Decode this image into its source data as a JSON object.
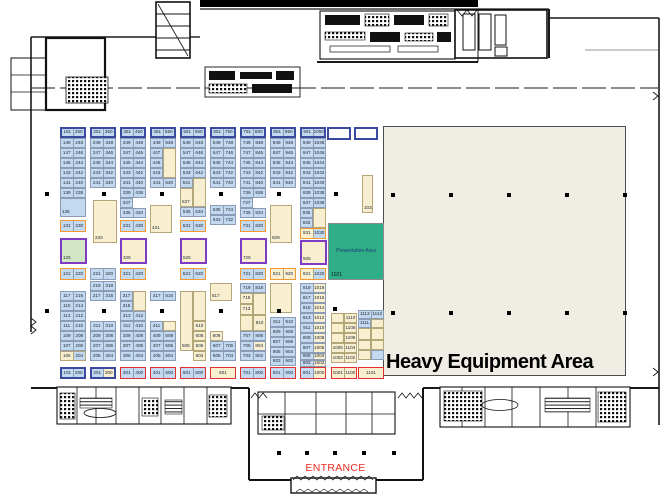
{
  "colors": {
    "booth_blue": "#c3d9ef",
    "booth_tan": "#f7efcf",
    "booth_green": "#d2e8c4",
    "booth_white": "#ffffff",
    "border_navy": "#3a4a9f",
    "border_orange": "#f09a2f",
    "border_purple": "#7e3bc4",
    "border_red": "#e23030",
    "presentation_green": "#2fae87",
    "heavy_fill": "#f0ede5",
    "entrance_red": "#ea2b20"
  },
  "areas": {
    "heavy_equipment": {
      "label": "Heavy Equipment Area"
    },
    "presentation": {
      "label": "Presentation Area",
      "booth": "1021"
    },
    "entrance": {
      "label": "ENTRANCE"
    }
  },
  "booths": [
    [
      60,
      127,
      26,
      11,
      "N",
      "b|b",
      "151|250"
    ],
    [
      60,
      138,
      26,
      10,
      "n",
      "b|b",
      "149|248"
    ],
    [
      60,
      148,
      26,
      10,
      "n",
      "b|b",
      "147|246"
    ],
    [
      60,
      158,
      26,
      10,
      "n",
      "b|b",
      "145|244"
    ],
    [
      60,
      168,
      26,
      10,
      "n",
      "b|b",
      "143|242"
    ],
    [
      60,
      178,
      26,
      10,
      "n",
      "b|b",
      "141|240"
    ],
    [
      60,
      188,
      26,
      10,
      "n",
      "b|b",
      "139|238"
    ],
    [
      60,
      198,
      26,
      19,
      "n",
      "b",
      "135"
    ],
    [
      60,
      220,
      26,
      12,
      "O",
      "b|b",
      "131|230"
    ],
    [
      60,
      238,
      27,
      26,
      "P",
      "g",
      "125"
    ],
    [
      60,
      268,
      26,
      12,
      "O",
      "b|b",
      "121|220"
    ],
    [
      60,
      291,
      26,
      10,
      "n",
      "b|b",
      "117|216"
    ],
    [
      60,
      301,
      26,
      10,
      "n",
      "b|b",
      "115|214"
    ],
    [
      60,
      311,
      26,
      10,
      "n",
      "b|b",
      "113|212"
    ],
    [
      60,
      321,
      26,
      10,
      "n",
      "b|b",
      "111|210"
    ],
    [
      60,
      331,
      26,
      10,
      "n",
      "b|b",
      "109|208"
    ],
    [
      60,
      341,
      26,
      10,
      "n",
      "b|b",
      "107|206"
    ],
    [
      60,
      351,
      26,
      10,
      "n",
      "t|b",
      "105|204"
    ],
    [
      60,
      367,
      26,
      12,
      "N",
      "b|b",
      "101|200"
    ],
    [
      90,
      127,
      26,
      11,
      "N",
      "b|b",
      "251|350"
    ],
    [
      90,
      138,
      26,
      10,
      "n",
      "b|b",
      "249|348"
    ],
    [
      90,
      148,
      26,
      10,
      "n",
      "b|b",
      "247|346"
    ],
    [
      90,
      158,
      26,
      10,
      "n",
      "b|b",
      "245|344"
    ],
    [
      90,
      168,
      26,
      10,
      "n",
      "b|b",
      "243|342"
    ],
    [
      90,
      178,
      26,
      10,
      "n",
      "b|b",
      "241|340"
    ],
    [
      93,
      200,
      24,
      43,
      "n",
      "t",
      "233"
    ],
    [
      90,
      268,
      26,
      12,
      "n",
      "b|b",
      "221|320"
    ],
    [
      90,
      281,
      26,
      10,
      "n",
      "b|b",
      "219|318"
    ],
    [
      90,
      291,
      26,
      10,
      "n",
      "b|b",
      "217|316"
    ],
    [
      90,
      321,
      26,
      10,
      "n",
      "b|b",
      "211|310"
    ],
    [
      90,
      331,
      26,
      10,
      "n",
      "b|b",
      "209|308"
    ],
    [
      90,
      341,
      26,
      10,
      "n",
      "b|b",
      "207|306"
    ],
    [
      90,
      351,
      26,
      10,
      "n",
      "b|b",
      "205|304"
    ],
    [
      90,
      367,
      26,
      12,
      "N",
      "b|t",
      "201|300"
    ],
    [
      120,
      127,
      26,
      11,
      "N",
      "b|b",
      "351|450"
    ],
    [
      120,
      138,
      26,
      10,
      "n",
      "b|b",
      "349|448"
    ],
    [
      120,
      148,
      26,
      10,
      "n",
      "b|b",
      "347|446"
    ],
    [
      120,
      158,
      26,
      10,
      "n",
      "b|b",
      "345|444"
    ],
    [
      120,
      168,
      26,
      10,
      "n",
      "b|b",
      "343|442"
    ],
    [
      120,
      178,
      26,
      10,
      "n",
      "b|b",
      "341|440"
    ],
    [
      120,
      188,
      26,
      10,
      "n",
      "b|b",
      "339|438"
    ],
    [
      120,
      198,
      13,
      10,
      "n",
      "b",
      "337"
    ],
    [
      120,
      208,
      26,
      10,
      "n",
      "b|b",
      "335|434"
    ],
    [
      120,
      220,
      26,
      12,
      "O",
      "b|b",
      "331|430"
    ],
    [
      120,
      238,
      27,
      26,
      "P",
      "t",
      "325"
    ],
    [
      120,
      268,
      26,
      12,
      "O",
      "b|b",
      "321|420"
    ],
    [
      120,
      291,
      13,
      10,
      "n",
      "b",
      "317"
    ],
    [
      133,
      291,
      13,
      20,
      "n",
      "t",
      ""
    ],
    [
      120,
      301,
      13,
      10,
      "n",
      "b",
      "315"
    ],
    [
      120,
      311,
      26,
      10,
      "n",
      "b|b",
      "313|412"
    ],
    [
      120,
      321,
      26,
      10,
      "n",
      "b|b",
      "311|410"
    ],
    [
      120,
      331,
      26,
      10,
      "n",
      "b|b",
      "309|408"
    ],
    [
      120,
      341,
      26,
      10,
      "n",
      "b|b",
      "307|406"
    ],
    [
      120,
      351,
      26,
      10,
      "n",
      "b|b",
      "305|404"
    ],
    [
      120,
      367,
      26,
      12,
      "R",
      "b|b",
      "301|400"
    ],
    [
      150,
      127,
      26,
      11,
      "N",
      "b|b",
      "451|550"
    ],
    [
      150,
      138,
      26,
      10,
      "n",
      "b|b",
      "449|548"
    ],
    [
      150,
      148,
      13,
      10,
      "n",
      "b",
      "447"
    ],
    [
      163,
      148,
      13,
      30,
      "n",
      "t",
      ""
    ],
    [
      150,
      158,
      13,
      10,
      "n",
      "b",
      "445"
    ],
    [
      150,
      168,
      13,
      10,
      "n",
      "b",
      "443"
    ],
    [
      150,
      178,
      26,
      10,
      "n",
      "b|b",
      "441|540"
    ],
    [
      150,
      205,
      22,
      28,
      "n",
      "t",
      "431"
    ],
    [
      150,
      291,
      26,
      10,
      "n",
      "b|b",
      "417|516"
    ],
    [
      150,
      321,
      13,
      10,
      "n",
      "b",
      "411"
    ],
    [
      163,
      321,
      13,
      10,
      "n",
      "t",
      ""
    ],
    [
      150,
      331,
      26,
      10,
      "n",
      "b|b",
      "409|508"
    ],
    [
      150,
      341,
      26,
      10,
      "n",
      "b|b",
      "407|506"
    ],
    [
      150,
      351,
      26,
      10,
      "n",
      "b|b",
      "405|504"
    ],
    [
      150,
      367,
      26,
      12,
      "R",
      "b|b",
      "401|500"
    ],
    [
      180,
      127,
      26,
      11,
      "N",
      "b|b",
      "551|650"
    ],
    [
      180,
      138,
      26,
      10,
      "n",
      "b|b",
      "549|648"
    ],
    [
      180,
      148,
      26,
      10,
      "n",
      "b|b",
      "547|646"
    ],
    [
      180,
      158,
      26,
      10,
      "n",
      "b|b",
      "545|644"
    ],
    [
      180,
      168,
      26,
      10,
      "n",
      "b|b",
      "543|642"
    ],
    [
      180,
      178,
      13,
      10,
      "n",
      "b",
      "541"
    ],
    [
      193,
      178,
      13,
      29,
      "n",
      "t",
      ""
    ],
    [
      180,
      188,
      13,
      19,
      "n",
      "t",
      "537"
    ],
    [
      180,
      207,
      26,
      10,
      "n",
      "b|b",
      "535|634"
    ],
    [
      180,
      220,
      26,
      12,
      "O",
      "b|b",
      "531|630"
    ],
    [
      180,
      238,
      27,
      26,
      "P",
      "t",
      "525"
    ],
    [
      180,
      268,
      26,
      12,
      "O",
      "b|b",
      "521|620"
    ],
    [
      180,
      291,
      13,
      60,
      "n",
      "t",
      "505"
    ],
    [
      193,
      291,
      13,
      30,
      "n",
      "t",
      ""
    ],
    [
      193,
      321,
      13,
      10,
      "n",
      "t",
      "610"
    ],
    [
      193,
      331,
      13,
      10,
      "n",
      "t",
      "608"
    ],
    [
      193,
      341,
      13,
      10,
      "n",
      "t",
      "606"
    ],
    [
      193,
      351,
      13,
      10,
      "n",
      "t",
      "604"
    ],
    [
      180,
      367,
      26,
      12,
      "R",
      "b|b",
      "501|600"
    ],
    [
      210,
      127,
      26,
      11,
      "N",
      "b|b",
      "651|750"
    ],
    [
      210,
      138,
      26,
      10,
      "n",
      "b|b",
      "649|748"
    ],
    [
      210,
      148,
      26,
      10,
      "n",
      "b|b",
      "647|746"
    ],
    [
      210,
      158,
      26,
      10,
      "n",
      "b|b",
      "645|744"
    ],
    [
      210,
      168,
      26,
      10,
      "n",
      "b|b",
      "643|742"
    ],
    [
      210,
      178,
      26,
      10,
      "n",
      "b|b",
      "641|740"
    ],
    [
      210,
      205,
      26,
      10,
      "n",
      "b|b",
      "635|734"
    ],
    [
      210,
      215,
      26,
      10,
      "n",
      "b|b",
      "633|732"
    ],
    [
      210,
      283,
      22,
      18,
      "n",
      "t",
      "617"
    ],
    [
      210,
      331,
      13,
      10,
      "n",
      "t",
      "609"
    ],
    [
      210,
      341,
      26,
      10,
      "n",
      "b|b",
      "607|706"
    ],
    [
      210,
      351,
      26,
      10,
      "n",
      "b|b",
      "605|704"
    ],
    [
      210,
      367,
      26,
      12,
      "R",
      "t",
      "601"
    ],
    [
      240,
      127,
      26,
      11,
      "N",
      "b|b",
      "751|850"
    ],
    [
      240,
      138,
      26,
      10,
      "n",
      "b|b",
      "749|848"
    ],
    [
      240,
      148,
      26,
      10,
      "n",
      "b|b",
      "747|846"
    ],
    [
      240,
      158,
      26,
      10,
      "n",
      "b|b",
      "745|844"
    ],
    [
      240,
      168,
      26,
      10,
      "n",
      "b|b",
      "743|842"
    ],
    [
      240,
      178,
      26,
      10,
      "n",
      "b|b",
      "741|840"
    ],
    [
      240,
      188,
      26,
      10,
      "n",
      "b|b",
      "739|838"
    ],
    [
      240,
      198,
      13,
      10,
      "n",
      "b",
      "737"
    ],
    [
      240,
      208,
      26,
      10,
      "n",
      "b|b",
      "735|834"
    ],
    [
      240,
      220,
      26,
      12,
      "O",
      "b|b",
      "731|830"
    ],
    [
      240,
      238,
      27,
      26,
      "P",
      "t",
      "725"
    ],
    [
      240,
      268,
      26,
      12,
      "O",
      "b|b",
      "721|820"
    ],
    [
      240,
      283,
      26,
      10,
      "n",
      "b|b",
      "719|818"
    ],
    [
      240,
      293,
      13,
      11,
      "n",
      "t",
      "715"
    ],
    [
      253,
      293,
      13,
      22,
      "n",
      "t",
      ""
    ],
    [
      240,
      304,
      13,
      11,
      "n",
      "t",
      "713"
    ],
    [
      240,
      315,
      13,
      16,
      "n",
      "t",
      ""
    ],
    [
      253,
      315,
      13,
      16,
      "n",
      "t",
      "810"
    ],
    [
      240,
      331,
      26,
      10,
      "n",
      "b|b",
      "707|806"
    ],
    [
      240,
      341,
      26,
      10,
      "n",
      "b|t",
      "705|804"
    ],
    [
      240,
      351,
      26,
      10,
      "n",
      "b|b",
      "703|802"
    ],
    [
      240,
      367,
      26,
      12,
      "R",
      "b|b",
      "701|800"
    ],
    [
      270,
      127,
      26,
      11,
      "N",
      "b|b",
      "851|950"
    ],
    [
      270,
      138,
      26,
      10,
      "n",
      "b|b",
      "849|948"
    ],
    [
      270,
      148,
      26,
      10,
      "n",
      "b|b",
      "847|946"
    ],
    [
      270,
      158,
      26,
      10,
      "n",
      "b|b",
      "845|944"
    ],
    [
      270,
      168,
      26,
      10,
      "n",
      "b|b",
      "843|942"
    ],
    [
      270,
      178,
      26,
      10,
      "n",
      "b|b",
      "841|940"
    ],
    [
      270,
      205,
      22,
      38,
      "n",
      "t",
      "829"
    ],
    [
      270,
      268,
      26,
      12,
      "O",
      "t|t",
      "821|920"
    ],
    [
      270,
      283,
      22,
      30,
      "n",
      "t",
      ""
    ],
    [
      270,
      317,
      26,
      10,
      "n",
      "b|b",
      "811|910"
    ],
    [
      270,
      327,
      26,
      10,
      "n",
      "b|b",
      "809|908"
    ],
    [
      270,
      337,
      26,
      10,
      "n",
      "b|b",
      "807|906"
    ],
    [
      270,
      347,
      26,
      10,
      "n",
      "b|b",
      "805|904"
    ],
    [
      270,
      357,
      26,
      9,
      "n",
      "b|b",
      "803|902"
    ],
    [
      270,
      367,
      26,
      12,
      "R",
      "b|b",
      "801|900"
    ],
    [
      300,
      127,
      26,
      11,
      "N",
      "b|b",
      "951|1050"
    ],
    [
      300,
      138,
      26,
      10,
      "n",
      "b|b",
      "949|1048"
    ],
    [
      300,
      148,
      26,
      10,
      "n",
      "b|b",
      "947|1046"
    ],
    [
      300,
      158,
      26,
      10,
      "n",
      "b|b",
      "945|1044"
    ],
    [
      300,
      168,
      26,
      10,
      "n",
      "b|b",
      "943|1042"
    ],
    [
      300,
      178,
      26,
      10,
      "n",
      "b|b",
      "941|1040"
    ],
    [
      300,
      188,
      26,
      10,
      "n",
      "b|b",
      "939|1038"
    ],
    [
      300,
      198,
      26,
      10,
      "n",
      "b|b",
      "937|1036"
    ],
    [
      300,
      208,
      13,
      10,
      "n",
      "b",
      "935"
    ],
    [
      313,
      208,
      13,
      20,
      "n",
      "t",
      ""
    ],
    [
      300,
      218,
      13,
      10,
      "n",
      "b",
      "933"
    ],
    [
      300,
      228,
      26,
      11,
      "O",
      "t|b",
      "931|1030"
    ],
    [
      300,
      240,
      27,
      25,
      "P",
      "t",
      "925"
    ],
    [
      300,
      268,
      26,
      12,
      "O",
      "t|b",
      "921|1020"
    ],
    [
      300,
      283,
      26,
      10,
      "n",
      "b|t",
      "919|1018"
    ],
    [
      300,
      293,
      26,
      10,
      "n",
      "b|t",
      "917|1016"
    ],
    [
      300,
      303,
      26,
      10,
      "n",
      "b|t",
      "915|1014"
    ],
    [
      300,
      313,
      26,
      10,
      "n",
      "b|t",
      "913|1012"
    ],
    [
      300,
      323,
      26,
      10,
      "n",
      "b|t",
      "911|1010"
    ],
    [
      300,
      333,
      26,
      10,
      "n",
      "b|t",
      "909|1008"
    ],
    [
      300,
      343,
      26,
      10,
      "n",
      "b|t",
      "907|1006"
    ],
    [
      300,
      353,
      26,
      7,
      "n",
      "b|t",
      "905|1004"
    ],
    [
      300,
      360,
      26,
      7,
      "n",
      "b|t",
      "903|1002"
    ],
    [
      300,
      367,
      26,
      12,
      "R",
      "b|t",
      "901|1000"
    ],
    [
      327,
      127,
      24,
      13,
      "N",
      "w",
      ""
    ],
    [
      354,
      127,
      24,
      13,
      "N",
      "w",
      ""
    ],
    [
      362,
      175,
      11,
      38,
      "n",
      "t",
      "1033"
    ],
    [
      331,
      313,
      13,
      10,
      "n",
      "t",
      ""
    ],
    [
      344,
      313,
      13,
      10,
      "n",
      "t",
      "1110"
    ],
    [
      331,
      323,
      13,
      10,
      "n",
      "t",
      ""
    ],
    [
      344,
      323,
      13,
      10,
      "n",
      "t",
      "1108"
    ],
    [
      331,
      333,
      13,
      10,
      "n",
      "t",
      ""
    ],
    [
      344,
      333,
      13,
      10,
      "n",
      "t",
      "1106"
    ],
    [
      331,
      343,
      26,
      10,
      "n",
      "t|t",
      "1005|1104"
    ],
    [
      331,
      353,
      26,
      10,
      "n",
      "t|t",
      "1003|1102"
    ],
    [
      331,
      367,
      26,
      12,
      "R",
      "t|t",
      "1001|1100"
    ],
    [
      358,
      310,
      26,
      9,
      "n",
      "b|b",
      "1113|1112"
    ],
    [
      358,
      319,
      13,
      9,
      "n",
      "b",
      "1111"
    ],
    [
      371,
      319,
      13,
      9,
      "n",
      "t",
      ""
    ],
    [
      358,
      328,
      13,
      12,
      "n",
      "t",
      ""
    ],
    [
      371,
      328,
      13,
      12,
      "n",
      "t",
      ""
    ],
    [
      358,
      340,
      13,
      10,
      "n",
      "t",
      ""
    ],
    [
      371,
      340,
      13,
      10,
      "n",
      "t",
      ""
    ],
    [
      358,
      350,
      13,
      10,
      "n",
      "t",
      ""
    ],
    [
      371,
      350,
      13,
      10,
      "n",
      "b",
      ""
    ],
    [
      358,
      367,
      26,
      12,
      "R",
      "t",
      "1101"
    ]
  ],
  "pillars": [
    [
      45,
      192
    ],
    [
      102,
      192
    ],
    [
      160,
      192
    ],
    [
      219,
      192
    ],
    [
      277,
      192
    ],
    [
      334,
      192
    ],
    [
      45,
      309
    ],
    [
      102,
      309
    ],
    [
      160,
      309
    ],
    [
      219,
      309
    ],
    [
      277,
      309
    ],
    [
      333,
      307
    ],
    [
      391,
      193
    ],
    [
      449,
      193
    ],
    [
      507,
      193
    ],
    [
      565,
      193
    ],
    [
      623,
      193
    ],
    [
      391,
      311
    ],
    [
      449,
      311
    ],
    [
      507,
      311
    ],
    [
      565,
      311
    ],
    [
      623,
      311
    ],
    [
      277,
      451
    ],
    [
      305,
      451
    ],
    [
      333,
      451
    ],
    [
      362,
      451
    ],
    [
      392,
      451
    ]
  ]
}
